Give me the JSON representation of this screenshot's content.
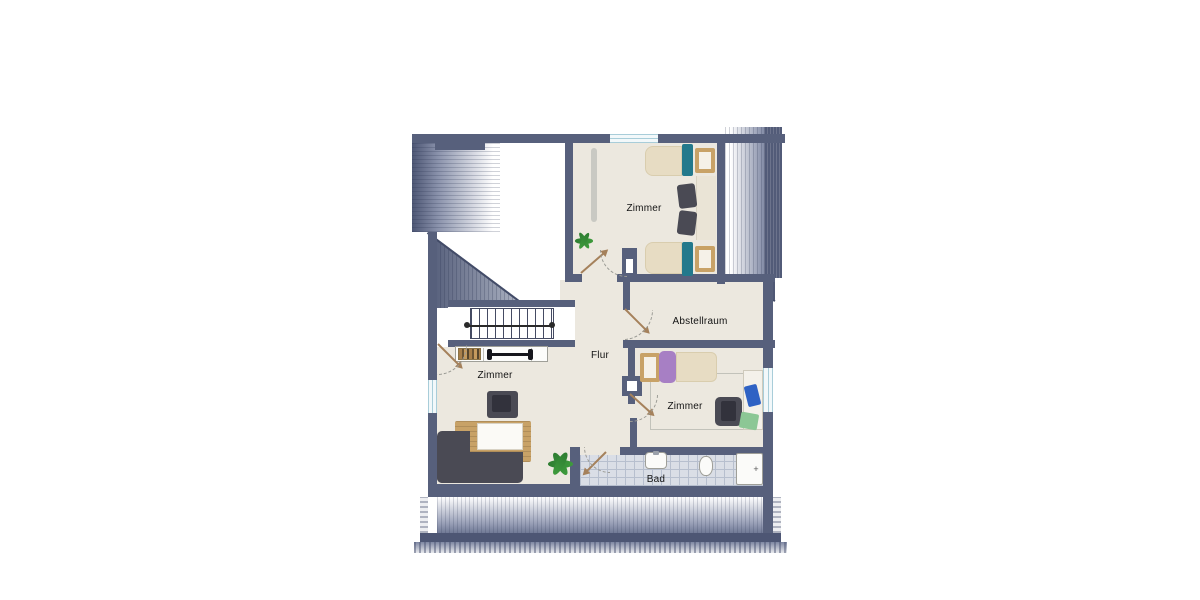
{
  "canvas": {
    "width": 1200,
    "height": 600,
    "background": "#ffffff"
  },
  "plan": {
    "type": "floor-plan",
    "rooms": {
      "zimmer_top": {
        "label": "Zimmer"
      },
      "zimmer_left": {
        "label": "Zimmer"
      },
      "zimmer_right": {
        "label": "Zimmer"
      },
      "abstellraum": {
        "label": "Abstellraum"
      },
      "flur": {
        "label": "Flur"
      },
      "bad": {
        "label": "Bad"
      }
    },
    "marks": {
      "shower_drain": "+"
    },
    "colors": {
      "wall": "#57607c",
      "hatch": "#4d5674",
      "floor": "#ece8df",
      "teal": "#23798c",
      "bedding": "#e7dcc3",
      "wood": "#c8a267",
      "purple": "#a77fc4",
      "dark-furn": "#4a4a54",
      "green": "#3e9b3c",
      "arrow": "#a5815b",
      "tile": "#dadee6",
      "tile-line": "#b7bfce",
      "window": "#f2f8fa",
      "window-line": "#a8cdd9"
    }
  }
}
